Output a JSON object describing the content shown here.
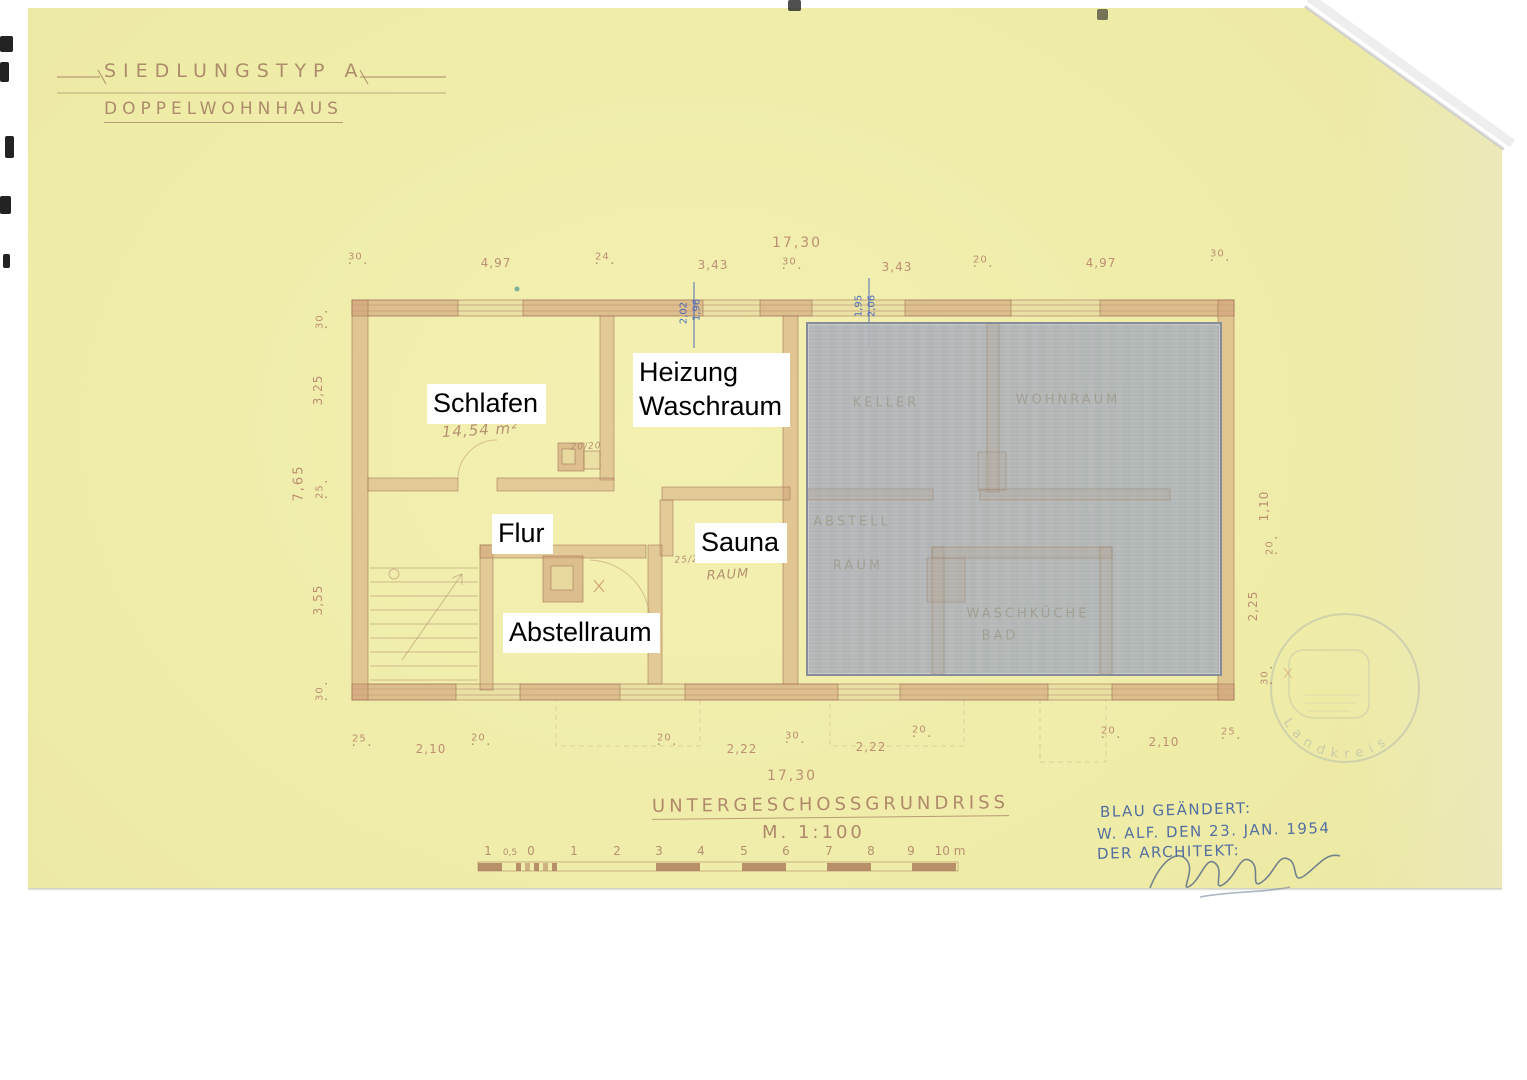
{
  "sheet": {
    "title_line1": "SIEDLUNGSTYP A",
    "title_line2": "DOPPELWOHNHAUS",
    "footer_title": "UNTERGESCHOSSGRUNDRISS",
    "footer_scale": "M. 1:100"
  },
  "rooms": {
    "schlafen": "Schlafen",
    "heizung_line1": "Heizung",
    "heizung_line2": "Waschraum",
    "flur": "Flur",
    "sauna": "Sauna",
    "abstellraum": "Abstellraum"
  },
  "pencils": [
    {
      "t": "14,54 m²",
      "x": 480,
      "y": 430
    },
    {
      "t": "20/20",
      "x": 586,
      "y": 447,
      "fs": 9
    },
    {
      "t": "25/25",
      "x": 690,
      "y": 560,
      "fs": 9
    },
    {
      "t": "RAUM",
      "x": 728,
      "y": 575,
      "fs": 13
    }
  ],
  "ghosts": [
    {
      "t": "KELLER",
      "x": 886,
      "y": 403
    },
    {
      "t": "WOHNRAUM",
      "x": 1068,
      "y": 400
    },
    {
      "t": "ABSTELL",
      "x": 852,
      "y": 522
    },
    {
      "t": "RAUM",
      "x": 858,
      "y": 566
    },
    {
      "t": "WASCHKÜCHE",
      "x": 1028,
      "y": 614
    },
    {
      "t": "BAD",
      "x": 1000,
      "y": 636
    }
  ],
  "dims": {
    "top": [
      {
        "t": "30",
        "x": 360,
        "y": 259,
        "k": "sm"
      },
      {
        "t": "4,97",
        "x": 496,
        "y": 263
      },
      {
        "t": "24",
        "x": 607,
        "y": 259,
        "k": "sm"
      },
      {
        "t": "3,43",
        "x": 713,
        "y": 265
      },
      {
        "t": "17,30",
        "x": 797,
        "y": 243,
        "k": "total"
      },
      {
        "t": "30",
        "x": 794,
        "y": 264,
        "k": "sm"
      },
      {
        "t": "3,43",
        "x": 897,
        "y": 267
      },
      {
        "t": "20",
        "x": 985,
        "y": 262,
        "k": "sm"
      },
      {
        "t": "4,97",
        "x": 1101,
        "y": 263
      },
      {
        "t": "30",
        "x": 1222,
        "y": 256,
        "k": "sm"
      }
    ],
    "bottom": [
      {
        "t": "25",
        "x": 364,
        "y": 741,
        "k": "sm"
      },
      {
        "t": "2,10",
        "x": 431,
        "y": 749
      },
      {
        "t": "20",
        "x": 483,
        "y": 740,
        "k": "sm"
      },
      {
        "t": "20",
        "x": 669,
        "y": 740,
        "k": "sm"
      },
      {
        "t": "2,22",
        "x": 742,
        "y": 749
      },
      {
        "t": "30",
        "x": 797,
        "y": 738,
        "k": "sm"
      },
      {
        "t": "2,22",
        "x": 871,
        "y": 747
      },
      {
        "t": "20",
        "x": 924,
        "y": 732,
        "k": "sm"
      },
      {
        "t": "20",
        "x": 1113,
        "y": 733,
        "k": "sm"
      },
      {
        "t": "2,10",
        "x": 1164,
        "y": 742
      },
      {
        "t": "25",
        "x": 1233,
        "y": 734,
        "k": "sm"
      },
      {
        "t": "17,30",
        "x": 792,
        "y": 776,
        "k": "total"
      }
    ],
    "left": [
      {
        "t": "30",
        "x": 322,
        "y": 317,
        "k": "sm rot"
      },
      {
        "t": "3,25",
        "x": 318,
        "y": 390,
        "k": "rot"
      },
      {
        "t": "7,65",
        "x": 299,
        "y": 483,
        "k": "total2"
      },
      {
        "t": "25",
        "x": 322,
        "y": 487,
        "k": "sm rot"
      },
      {
        "t": "3,55",
        "x": 318,
        "y": 600,
        "k": "rot"
      },
      {
        "t": "30",
        "x": 322,
        "y": 689,
        "k": "sm rot"
      }
    ],
    "right": [
      {
        "t": "1,10",
        "x": 1264,
        "y": 506,
        "k": "rot"
      },
      {
        "t": "20",
        "x": 1272,
        "y": 543,
        "k": "sm rot"
      },
      {
        "t": "2,25",
        "x": 1253,
        "y": 606,
        "k": "rot"
      },
      {
        "t": "30",
        "x": 1267,
        "y": 673,
        "k": "sm rot"
      }
    ],
    "blue": [
      {
        "t": "2,02",
        "x": 684,
        "y": 313,
        "k": "rot blue"
      },
      {
        "t": "1,96",
        "x": 697,
        "y": 310,
        "k": "rot blue"
      },
      {
        "t": "1,95",
        "x": 859,
        "y": 306,
        "k": "rot blue"
      },
      {
        "t": "2,06",
        "x": 872,
        "y": 306,
        "k": "rot blue"
      }
    ]
  },
  "scalebar": {
    "labels": [
      {
        "t": "1",
        "x": 488,
        "y": 851
      },
      {
        "t": "0,5",
        "x": 510,
        "y": 853,
        "k": "sm"
      },
      {
        "t": "0",
        "x": 531,
        "y": 851
      },
      {
        "t": "1",
        "x": 574,
        "y": 851
      },
      {
        "t": "2",
        "x": 617,
        "y": 851
      },
      {
        "t": "3",
        "x": 659,
        "y": 851
      },
      {
        "t": "4",
        "x": 701,
        "y": 851
      },
      {
        "t": "5",
        "x": 744,
        "y": 851
      },
      {
        "t": "6",
        "x": 786,
        "y": 851
      },
      {
        "t": "7",
        "x": 829,
        "y": 851
      },
      {
        "t": "8",
        "x": 871,
        "y": 851
      },
      {
        "t": "9",
        "x": 911,
        "y": 851
      },
      {
        "t": "10 m",
        "x": 950,
        "y": 851
      }
    ]
  },
  "note": {
    "line1": "BLAU GEÄNDERT:",
    "line2": "W. ALF. DEN 23. JAN. 1954",
    "line3": "DER ARCHITEKT:"
  },
  "stamp": {
    "ring_text": "Landkreis"
  },
  "colors": {
    "paper": "#efeca8",
    "pencil_ink": "#ab8165",
    "wall": "#cf9e78",
    "blue_ink": "#44629f",
    "overlay": "#a6acba"
  }
}
